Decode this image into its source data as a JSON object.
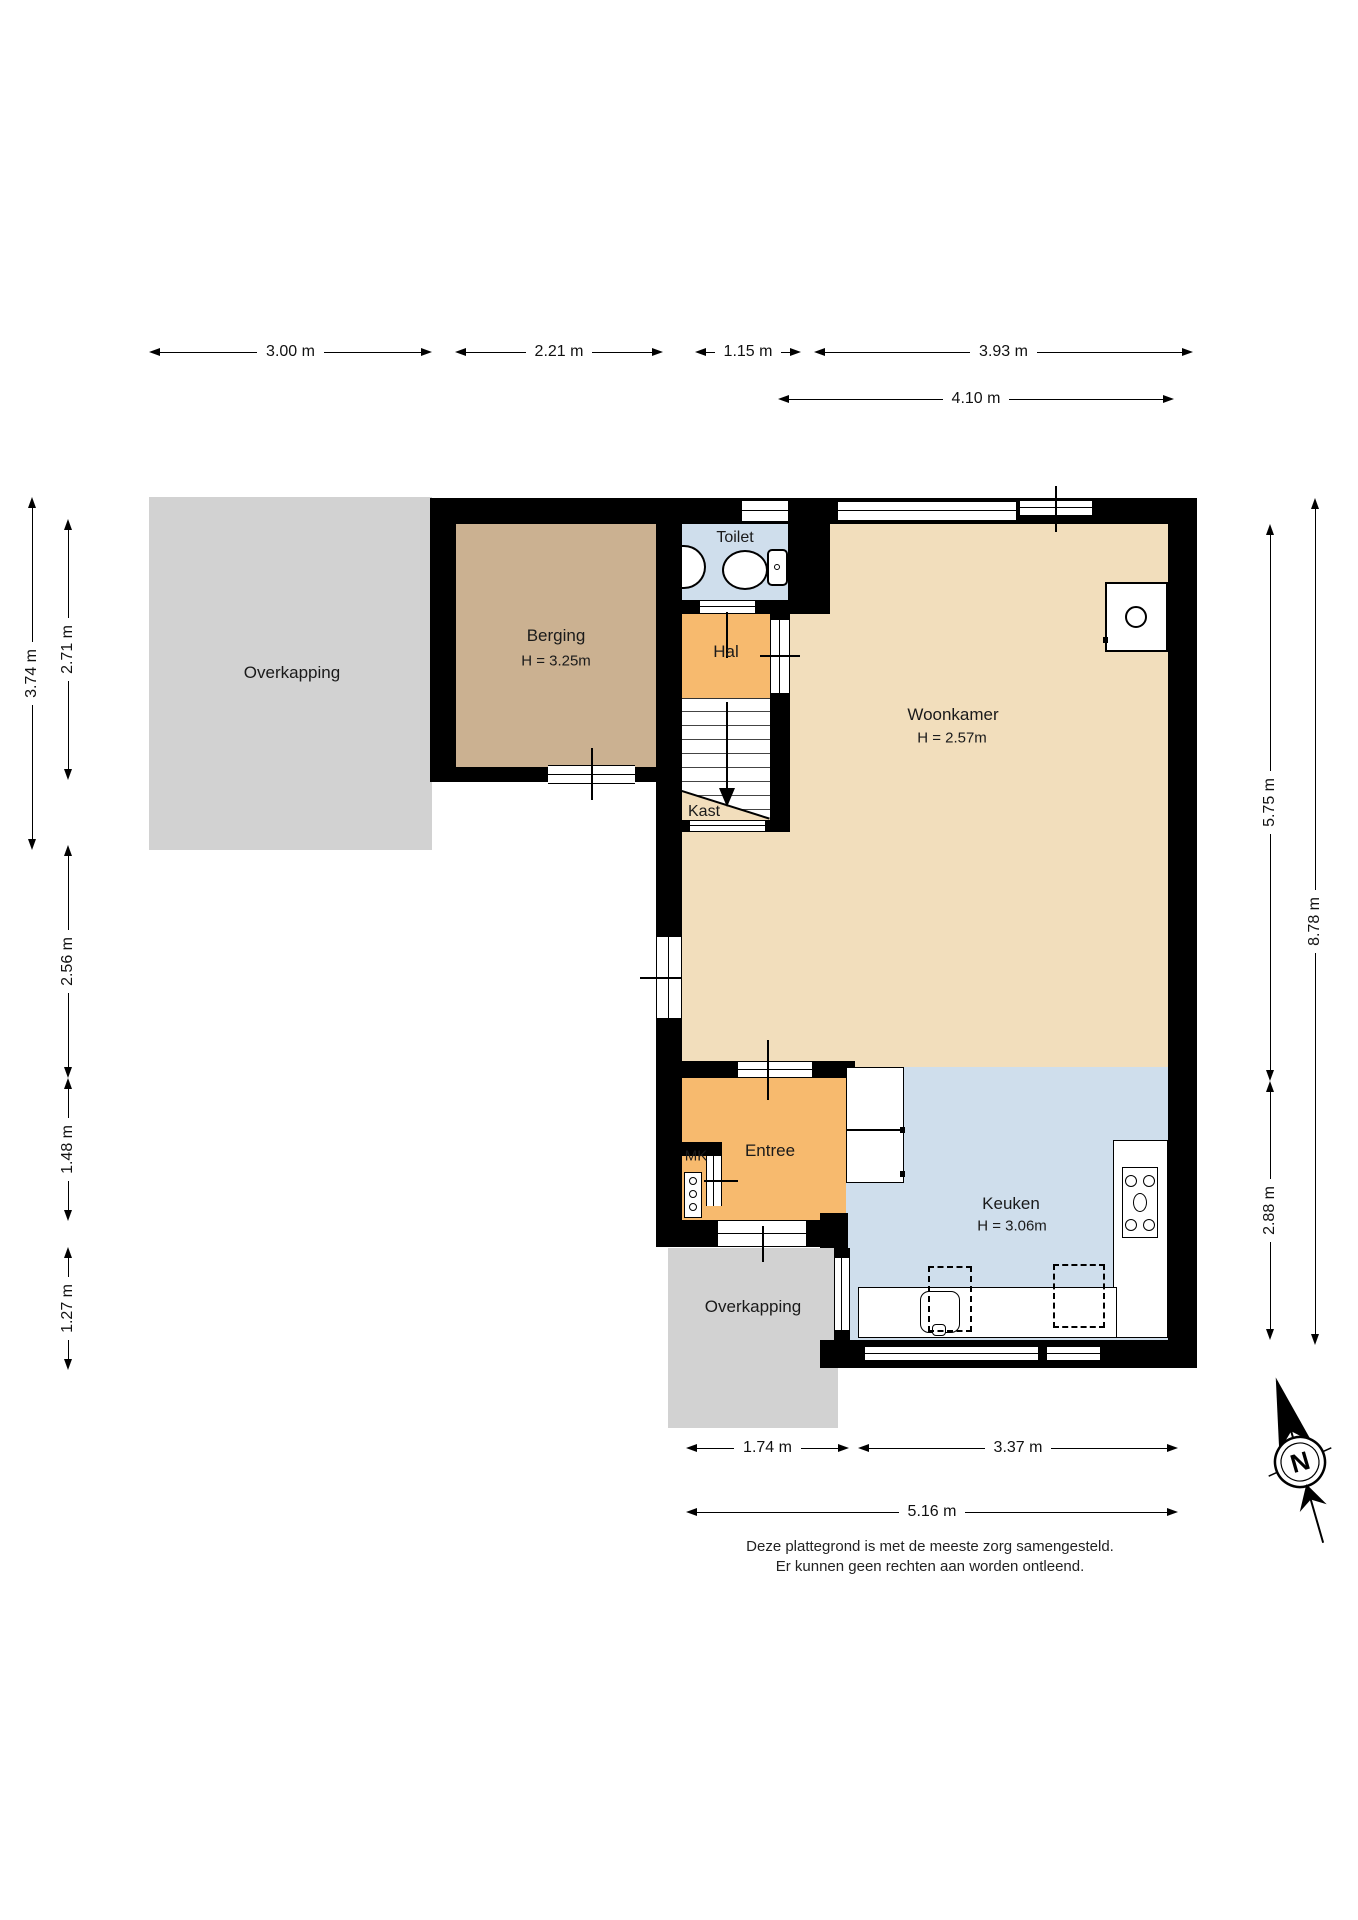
{
  "rooms": {
    "overkapping_top": {
      "label": "Overkapping"
    },
    "berging": {
      "label": "Berging",
      "height": "H = 3.25m"
    },
    "toilet": {
      "label": "Toilet"
    },
    "hal": {
      "label": "Hal"
    },
    "woonkamer": {
      "label": "Woonkamer",
      "height": "H = 2.57m"
    },
    "kast": {
      "label": "Kast"
    },
    "entree": {
      "label": "Entree"
    },
    "mk": {
      "label": "MK"
    },
    "keuken": {
      "label": "Keuken",
      "height": "H = 3.06m"
    },
    "overkapping_bottom": {
      "label": "Overkapping"
    }
  },
  "dimensions": {
    "top": [
      "3.00 m",
      "2.21 m",
      "1.15 m",
      "3.93 m"
    ],
    "top2": [
      "4.10 m"
    ],
    "left": [
      "3.74 m",
      "2.71 m",
      "2.56 m",
      "1.48 m",
      "1.27 m"
    ],
    "right": [
      "5.75 m",
      "2.88 m",
      "8.78 m"
    ],
    "bottom": [
      "1.74 m",
      "3.37 m"
    ],
    "bottom2": [
      "5.16 m"
    ]
  },
  "compass": {
    "label": "N"
  },
  "footer": {
    "line1": "Deze plattegrond is met de meeste zorg samengesteld.",
    "line2": "Er kunnen geen rechten aan worden ontleend."
  },
  "colors": {
    "wall": "#000000",
    "woonkamer": "#f2debc",
    "berging": "#cbb191",
    "hal_entree": "#f7ba6e",
    "toilet_keuken": "#cfdeec",
    "overkapping": "#d2d2d2"
  }
}
